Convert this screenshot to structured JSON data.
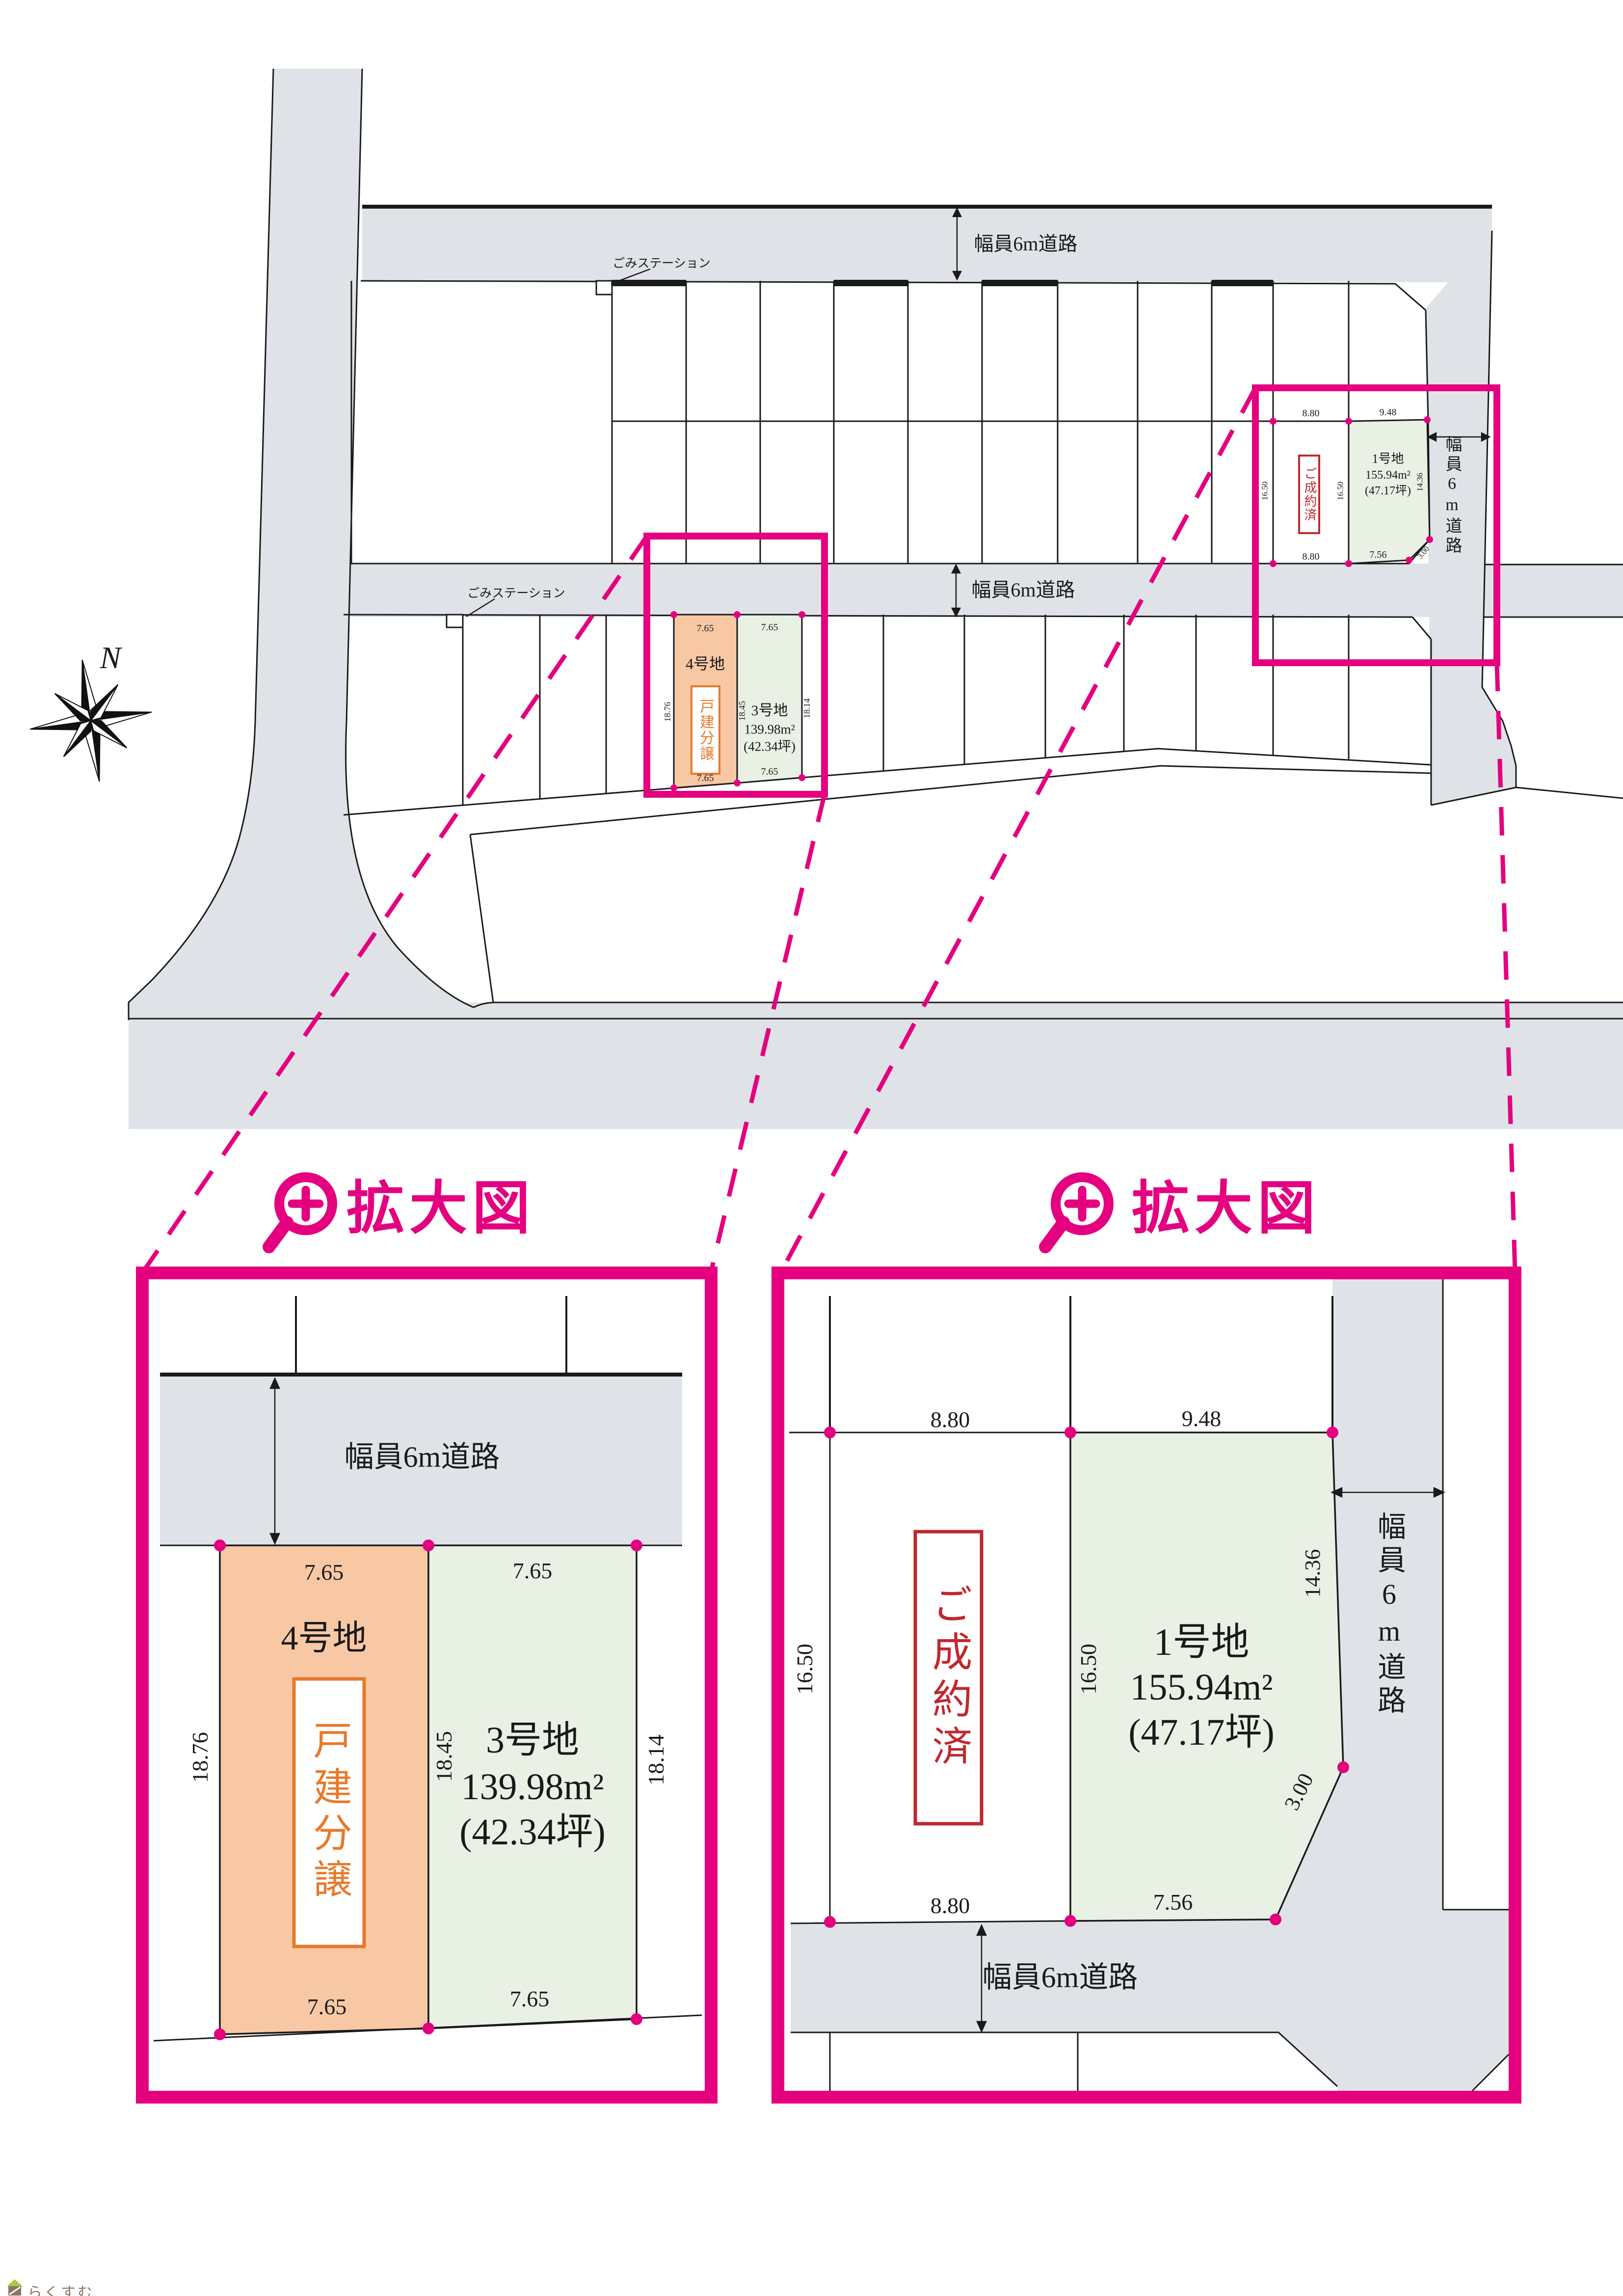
{
  "titles": {
    "magnified_view": "拡大図"
  },
  "compass": {
    "north": "N"
  },
  "roads": {
    "width_6m": "幅員6m道路"
  },
  "features": {
    "garbage_station": "ごみステーション"
  },
  "lots": {
    "lot1": {
      "name": "1号地",
      "area_m2": "155.94m²",
      "area_tsubo": "(47.17坪)",
      "status": "ご成約済"
    },
    "lot3": {
      "name": "3号地",
      "area_m2": "139.98m²",
      "area_tsubo": "(42.34坪)"
    },
    "lot4": {
      "name": "4号地",
      "sale_type": "戸建分譲"
    }
  },
  "dims": {
    "w765": "7.65",
    "s1876": "18.76",
    "s1845": "18.45",
    "s1814": "18.14",
    "w880": "8.80",
    "w948": "9.48",
    "w756": "7.56",
    "c300": "3.00",
    "s1650": "16.50",
    "s1436": "14.36"
  },
  "colors": {
    "magenta": "#e4007f",
    "road_gray": "#dfe3e8",
    "lot_orange": "#f8c8a5",
    "lot_green": "#e9f1e4",
    "accent_orange": "#e8792c",
    "accent_red": "#c1272d",
    "line_black": "#1a1a1a",
    "brand_brown": "#8a7565",
    "brand_green": "#aec943"
  },
  "footer": {
    "brand": "らくすむ"
  }
}
